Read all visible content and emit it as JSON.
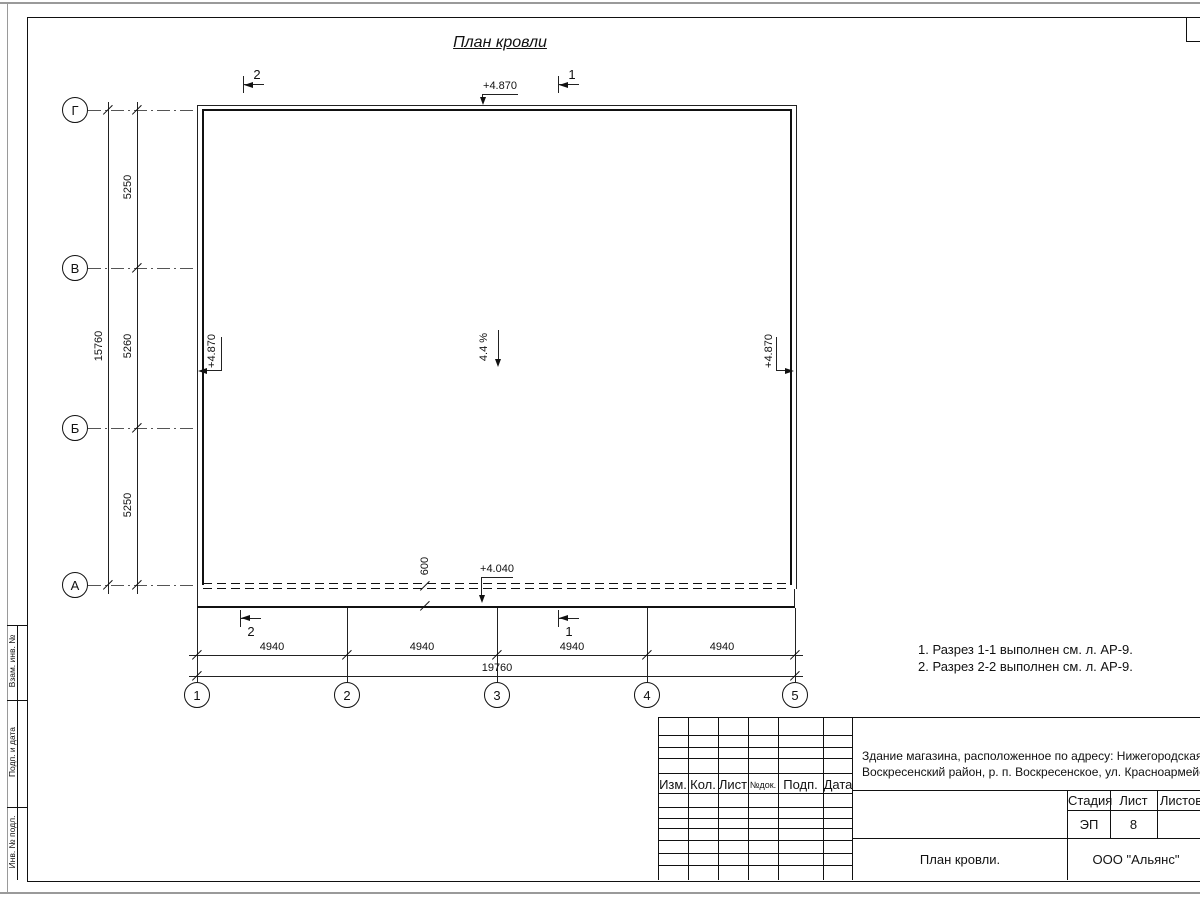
{
  "title": "План кровли",
  "plan": {
    "slope_label": "4.4 %",
    "elev_top": "+4.870",
    "elev_left": "+4.870",
    "elev_right": "+4.870",
    "elev_canopy": "+4.040",
    "canopy_depth": "600",
    "row_axes": [
      "Г",
      "В",
      "Б",
      "А"
    ],
    "row_dims": [
      "5250",
      "5260",
      "5250"
    ],
    "row_total": "15760",
    "col_axes": [
      "1",
      "2",
      "3",
      "4",
      "5"
    ],
    "col_dims": [
      "4940",
      "4940",
      "4940",
      "4940"
    ],
    "col_total": "19760",
    "sections": {
      "top_left": "2",
      "top_right": "1",
      "bottom_left": "2",
      "bottom_right": "1"
    }
  },
  "notes": [
    "1. Разрез 1-1 выполнен см. л. АР-9.",
    "2. Разрез 2-2 выполнен см. л. АР-9."
  ],
  "title_block": {
    "col_izm": "Изм.",
    "col_kol": "Кол.",
    "col_list": "Лист",
    "col_ndok": "№док.",
    "col_podp": "Подп.",
    "col_data": "Дата",
    "stage_label": "Стадия",
    "sheet_label": "Лист",
    "sheets_label": "Листов",
    "stage_value": "ЭП",
    "sheet_value": "8",
    "doc_title": "План кровли.",
    "company": "ООО \"Альянс\"",
    "object_line1": "Здание магазина, расположенное по адресу: Нижегородская область,",
    "object_line2": "Воскресенский район, р. п. Воскресенское, ул. Красноармейская, д. 1"
  },
  "margin": {
    "stamp1": "Взам. инв. №",
    "stamp2": "Подп. и дата",
    "stamp3": "Инв. № подл."
  }
}
